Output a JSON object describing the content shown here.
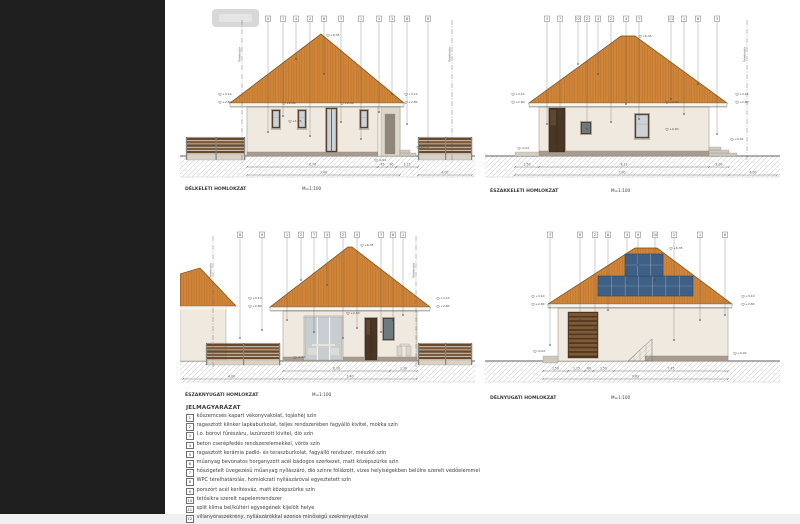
{
  "app": {
    "sidebar_color": "#1f1f1f",
    "page_color": "#ffffff",
    "footer_color": "#f0f0f0"
  },
  "boundary_label": "Telekhatár",
  "colors": {
    "roof": "#d0853a",
    "wall": "#efe9e0",
    "plinth": "#a79c8d",
    "fence_slat": "#6b4a2c",
    "solar_panel": "#3e5f86",
    "frame_brown": "#5d4730"
  },
  "elevations": [
    {
      "id": "delkeleti",
      "title": "DÉLKELETI HOMLOKZAT",
      "scale": "M=1:100",
      "callouts": [
        "5",
        "7",
        "4",
        "2",
        "6",
        "7",
        "1",
        "3",
        "3",
        "6",
        "8"
      ],
      "ridge_level": "+6,35",
      "levels_left": [
        "+3,10",
        "+2,80"
      ],
      "levels_right": [
        "+3,10",
        "+2,80"
      ],
      "annotations": [
        "+2,40",
        "+2,40",
        "+1,25",
        "+0,02",
        "-0,02"
      ],
      "dims": [
        [
          "6,70",
          "45",
          "90",
          "1,15"
        ],
        [
          "7,40",
          "4,00"
        ]
      ]
    },
    {
      "id": "eszakkeleti",
      "title": "ÉSZAKKELETI HOMLOKZAT",
      "scale": "M=1:100",
      "callouts": [
        "5",
        "7",
        "12",
        "2",
        "4",
        "2",
        "4",
        "7",
        "11",
        "1",
        "6",
        "3"
      ],
      "ridge_level": "+6,35",
      "levels_left": [
        "+3,10",
        "+2,80"
      ],
      "levels_right": [
        "+3,10",
        "+2,80"
      ],
      "annotations": [
        "+2,40",
        "+0,90",
        "-0,02",
        "+0,02"
      ],
      "dims": [
        [
          "1,50",
          "8,13",
          "1,00"
        ],
        [
          "7,90",
          "4,00"
        ]
      ]
    },
    {
      "id": "eszaknyugati",
      "title": "ÉSZAKNYUGATI HOMLOKZAT",
      "scale": "M=1:100",
      "callouts": [
        "8",
        "9",
        "1",
        "2",
        "7",
        "4",
        "2",
        "5",
        "7",
        "6",
        "1"
      ],
      "ridge_level": "+6,35",
      "levels_left": [
        "+3,10",
        "+2,80"
      ],
      "levels_right": [
        "+3,10",
        "+2,80"
      ],
      "annotations": [
        "+2,40",
        "-0,02"
      ],
      "dims": [
        [
          "6,10",
          "1,30"
        ],
        [
          "4,00",
          "7,40"
        ]
      ]
    },
    {
      "id": "delnyugati",
      "title": "DÉLNYUGATI HOMLOKZAT",
      "scale": "M=1:100",
      "callouts": [
        "3",
        "8",
        "2",
        "6",
        "4",
        "9",
        "10",
        "2",
        "1",
        "6"
      ],
      "ridge_level": "+6,35",
      "levels_left": [
        "+3,10",
        "+2,80"
      ],
      "levels_right": [
        "+3,10",
        "+2,80"
      ],
      "annotations": [
        "-0,02",
        "+0,02"
      ],
      "dims": [
        [
          "1,50",
          "1,15",
          "60",
          "1,50",
          "7,45"
        ],
        [
          "9,63"
        ]
      ]
    }
  ],
  "legend": {
    "title": "JELMAGYARÁZAT",
    "items": [
      {
        "num": "1",
        "text": "kőszemcsés kapart vékonyvakolat, tojáshéj szín"
      },
      {
        "num": "2",
        "text": "ragasztott klinker lapkaburkolat, teljes rendszerében fagyálló kivitel, mokka szín"
      },
      {
        "num": "3",
        "text": "I.o. borovi fűrészáru, lazúrozott kivitel, dió szín"
      },
      {
        "num": "4",
        "text": "beton cserépfedés rendszerelemekkel, vörös szín"
      },
      {
        "num": "5",
        "text": "ragasztott kerámia padló- és teraszburkolat, fagyálló rendszer, mészkő szín"
      },
      {
        "num": "6",
        "text": "műanyag bevonatos horganyzott acél bádogos szerkezet, matt középszürke szín"
      },
      {
        "num": "7",
        "text": "hőszigetelt üvegezésű műanyag nyílászáró, dió színre fóliázott, vizes helyiségekben belülre szerelt védőelemmel"
      },
      {
        "num": "8",
        "text": "WPC térelhatárolás, homlokzati nyílászáróval egyeztetett szín"
      },
      {
        "num": "9",
        "text": "porszórt acél kerítésváz, matt középszürke szín"
      },
      {
        "num": "10",
        "text": "tetősíkra szerelt napelemrendszer"
      },
      {
        "num": "11",
        "text": "split klíma bel/kültéri egységének kijelölt helye"
      },
      {
        "num": "12",
        "text": "villanyóraszekrény, nyílászárókkal azonos minőségű szekrényajtóval"
      }
    ]
  }
}
